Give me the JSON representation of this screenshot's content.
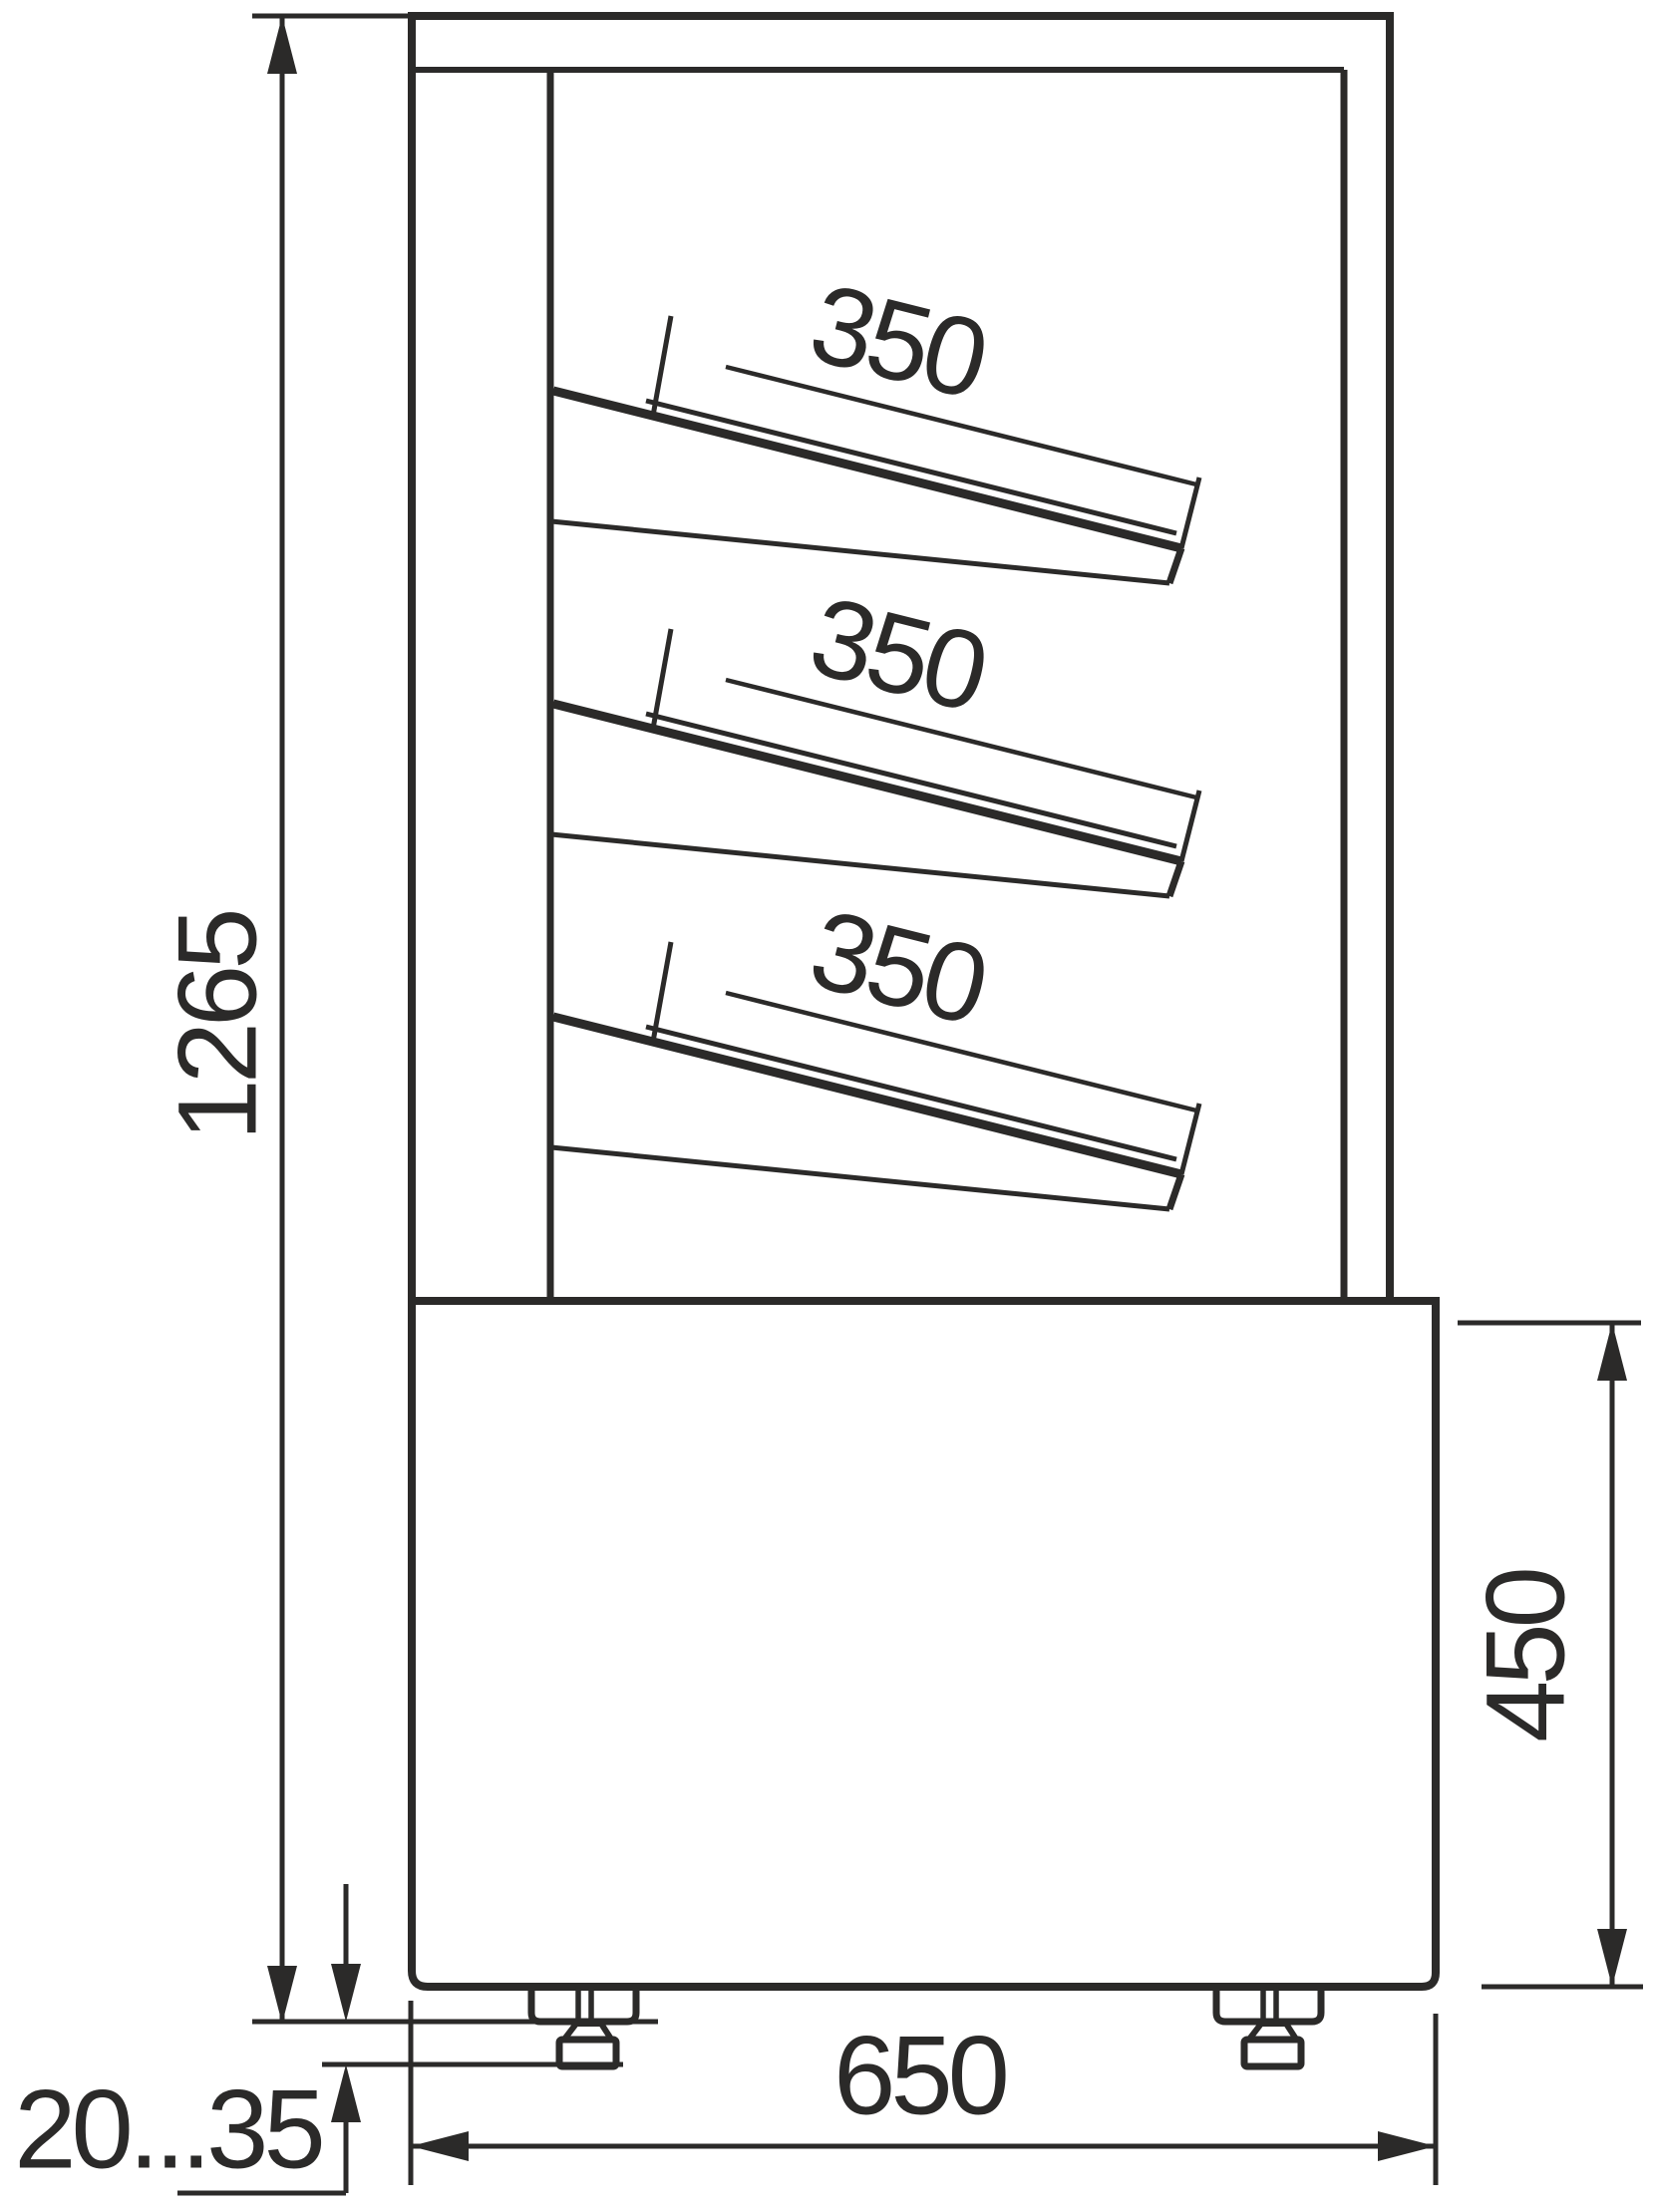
{
  "drawing": {
    "kind": "technical dimension drawing, display case side view",
    "line_color": "#2b2a29",
    "background": "#ffffff",
    "dimensions": {
      "overall_height": "1265",
      "shelf_depths": [
        "350",
        "350",
        "350"
      ],
      "base_height": "450",
      "overall_depth": "650",
      "foot_height_range": "20...35"
    }
  }
}
